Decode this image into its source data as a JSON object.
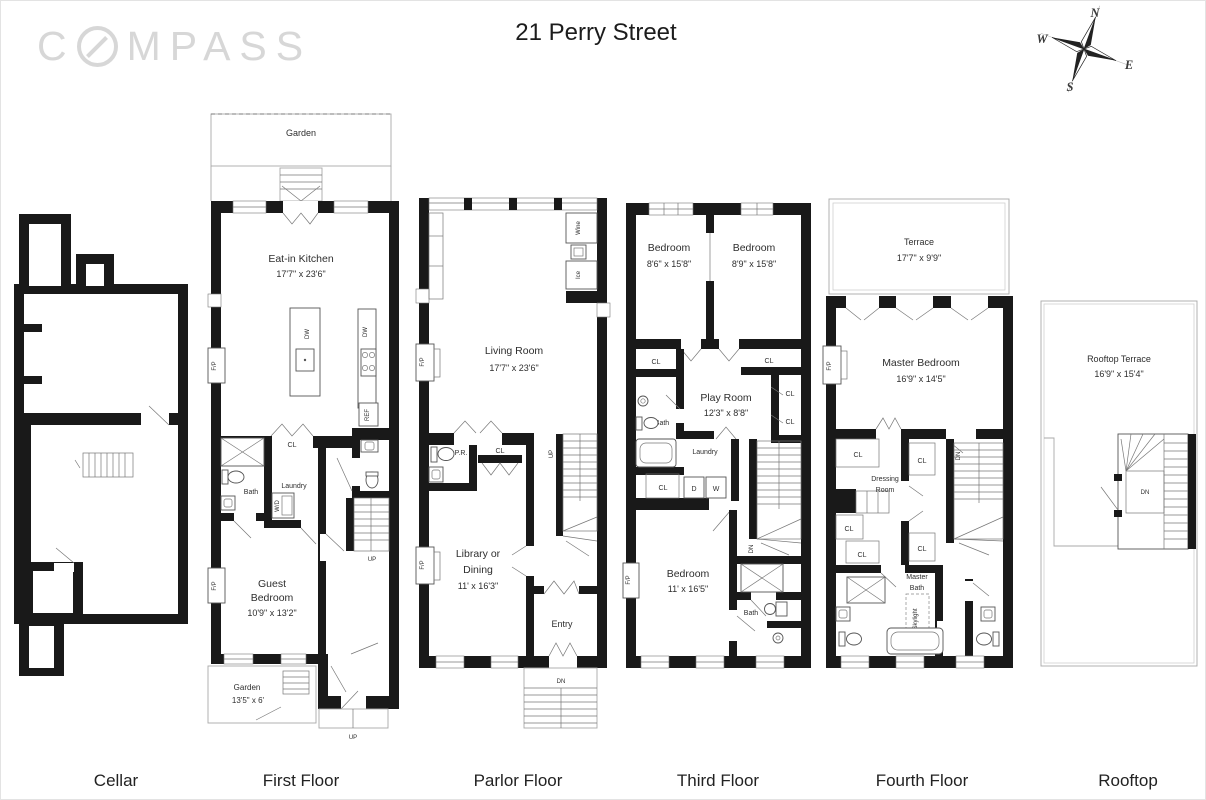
{
  "header": {
    "logo_prefix": "C",
    "logo_suffix": "MPASS",
    "title": "21 Perry Street"
  },
  "compass_rose": {
    "n": "N",
    "e": "E",
    "s": "S",
    "w": "W"
  },
  "captions": [
    "Cellar",
    "First Floor",
    "Parlor Floor",
    "Third Floor",
    "Fourth Floor",
    "Rooftop"
  ],
  "first": {
    "garden_top": "Garden",
    "kitchen_name": "Eat-in Kitchen",
    "kitchen_dims": "17'7\" x 23'6\"",
    "island_dw": "DW",
    "counter_dw": "DW",
    "ref": "REF",
    "fp": "F/P",
    "cl": "CL",
    "bath": "Bath",
    "laundry": "Laundry",
    "wd": "W/D",
    "up_stairs": "UP",
    "guest_line1": "Guest",
    "guest_line2": "Bedroom",
    "guest_dims": "10'9\" x 13'2\"",
    "garden_bottom": "Garden",
    "garden_bottom_dims": "13'5\" x 6'",
    "up_stoop": "UP"
  },
  "parlor": {
    "wine": "Wine",
    "ice": "Ice",
    "living_name": "Living Room",
    "living_dims": "17'7\" x 23'6\"",
    "fp": "F/P",
    "pr": "P.R.",
    "cl": "CL",
    "up": "UP",
    "library_line1": "Library or",
    "library_line2": "Dining",
    "library_dims": "11' x 16'3\"",
    "entry": "Entry",
    "dn": "DN"
  },
  "third": {
    "bedroom": "Bedroom",
    "bedroom1_dims": "8'6\" x 15'8\"",
    "bedroom2_dims": "8'9\" x 15'8\"",
    "cl": "CL",
    "playroom_name": "Play Room",
    "playroom_dims": "12'3\" x 8'8\"",
    "bath": "Bath",
    "laundry": "Laundry",
    "d": "D",
    "w": "W",
    "bedroom3_dims": "11' x 16'5\"",
    "fp": "F/P",
    "dn": "DN"
  },
  "fourth": {
    "terrace_name": "Terrace",
    "terrace_dims": "17'7\" x 9'9\"",
    "master_name": "Master Bedroom",
    "master_dims": "16'9\" x 14'5\"",
    "fp": "F/P",
    "cl": "CL",
    "dressing_line1": "Dressing",
    "dressing_line2": "Room",
    "bath_line1": "Master",
    "bath_line2": "Bath",
    "skylight": "Skylight",
    "dn": "DN"
  },
  "rooftop": {
    "name": "Rooftop Terrace",
    "dims": "16'9\" x 15'4\"",
    "dn": "DN"
  }
}
